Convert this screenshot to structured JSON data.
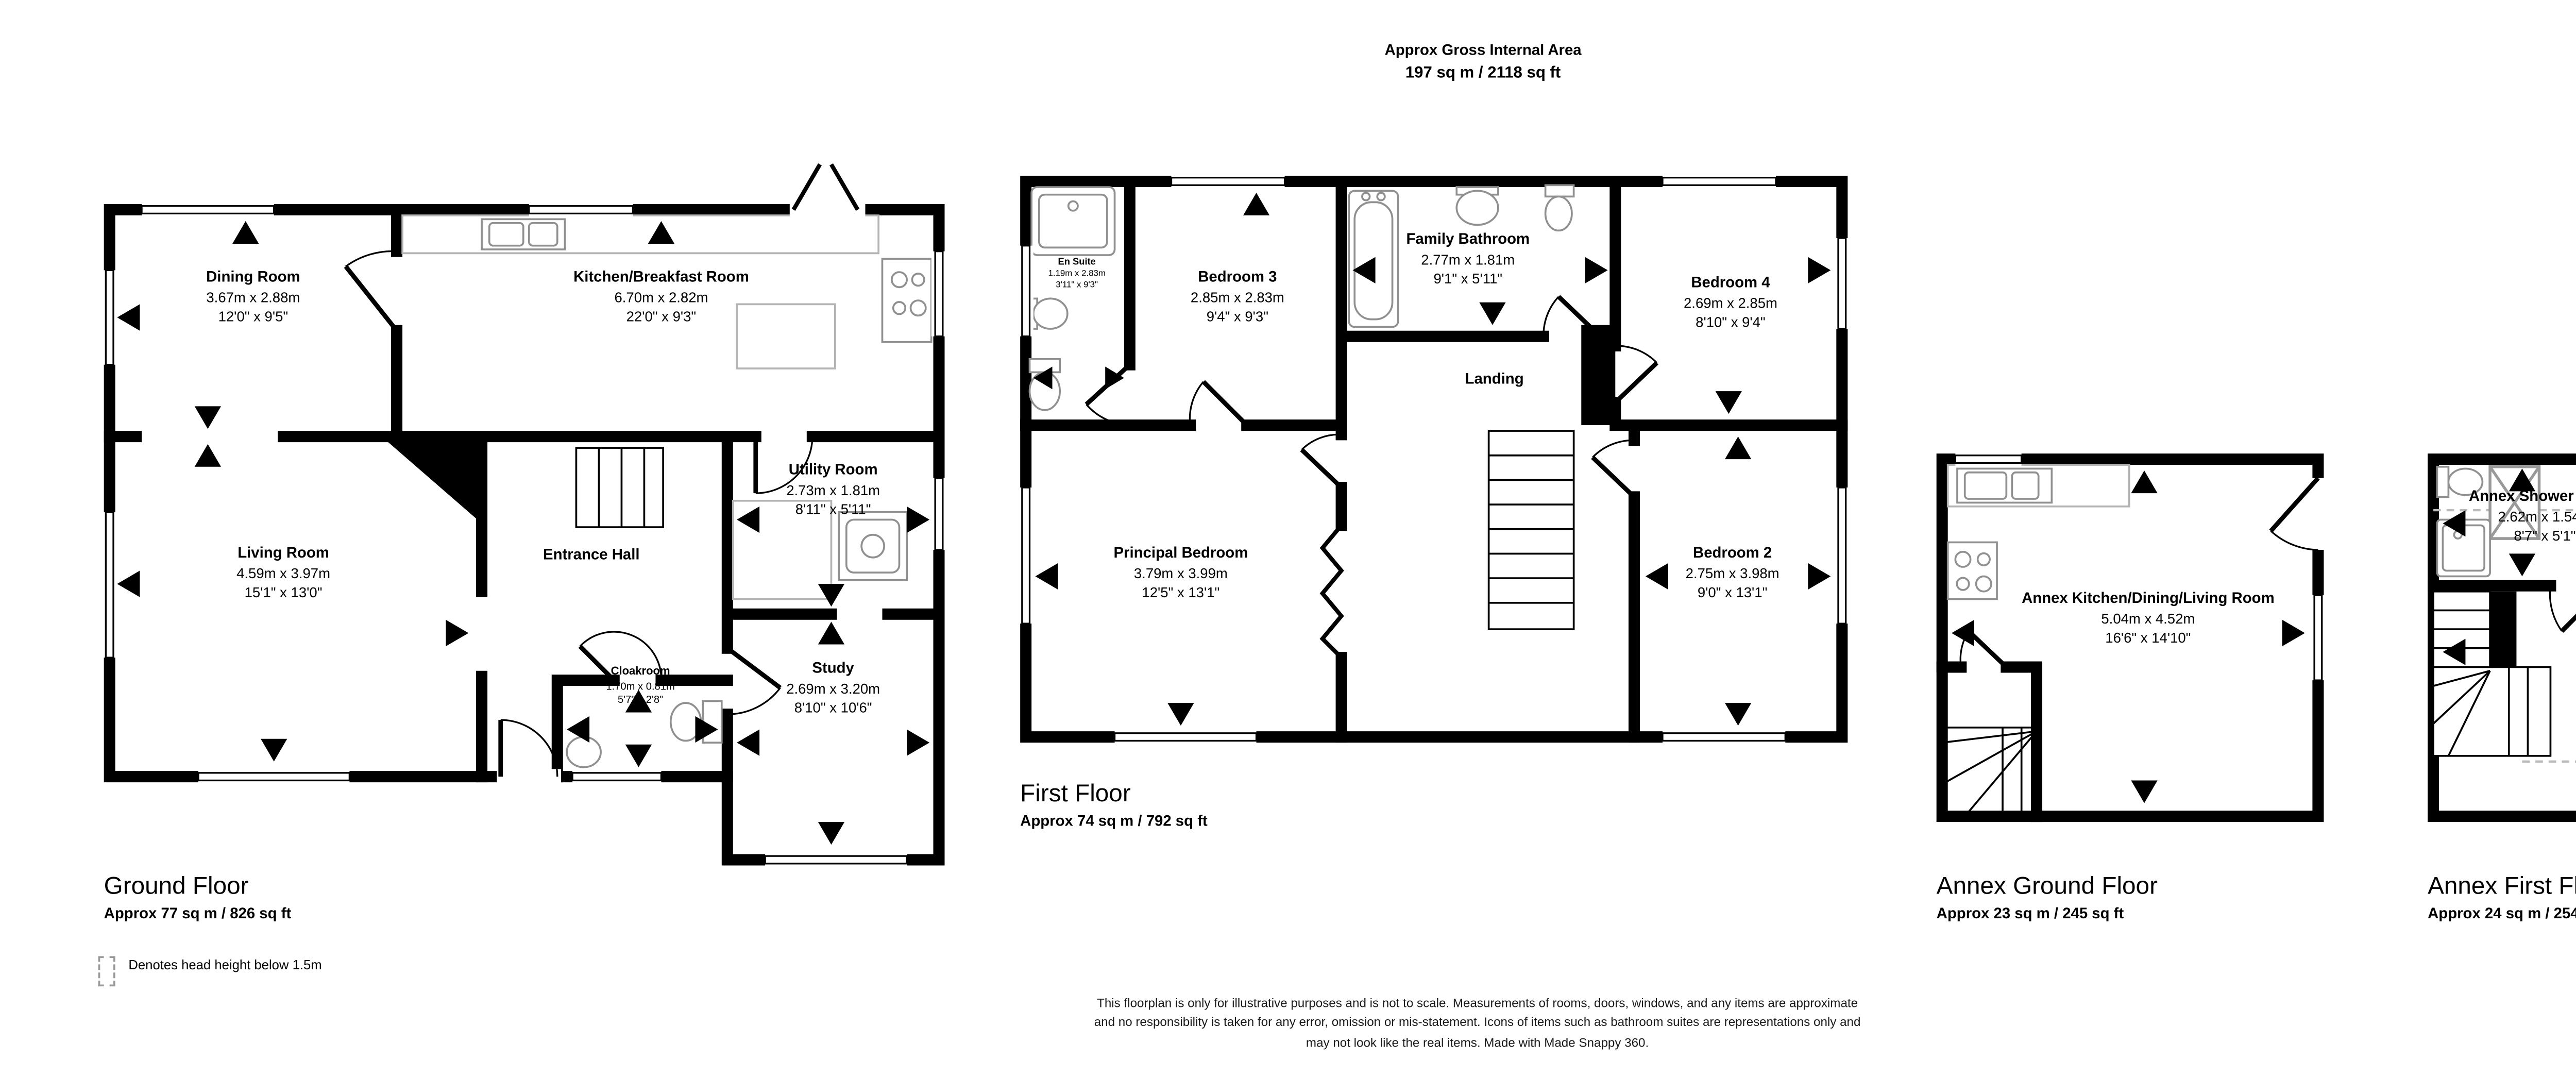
{
  "header": {
    "title": "Approx Gross Internal Area",
    "area": "197 sq m / 2118 sq ft"
  },
  "floors": [
    {
      "caption": "Ground Floor",
      "area": "Approx 77 sq m / 826 sq ft",
      "rooms": {
        "dining": {
          "name": "Dining Room",
          "metric": "3.67m x 2.88m",
          "imperial": "12'0\" x 9'5\""
        },
        "kitchen": {
          "name": "Kitchen/Breakfast Room",
          "metric": "6.70m x 2.82m",
          "imperial": "22'0\" x 9'3\""
        },
        "living": {
          "name": "Living Room",
          "metric": "4.59m x 3.97m",
          "imperial": "15'1\" x 13'0\""
        },
        "hall": {
          "name": "Entrance Hall"
        },
        "utility": {
          "name": "Utility Room",
          "metric": "2.73m x 1.81m",
          "imperial": "8'11\" x 5'11\""
        },
        "cloak": {
          "name": "Cloakroom",
          "metric": "1.70m x 0.81m",
          "imperial": "5'7\" x 2'8\""
        },
        "study": {
          "name": "Study",
          "metric": "2.69m x 3.20m",
          "imperial": "8'10\" x 10'6\""
        }
      }
    },
    {
      "caption": "First Floor",
      "area": "Approx 74 sq m / 792 sq ft",
      "rooms": {
        "ensuite": {
          "name": "En Suite",
          "metric": "1.19m x 2.83m",
          "imperial": "3'11\" x 9'3\""
        },
        "bed3": {
          "name": "Bedroom 3",
          "metric": "2.85m x 2.83m",
          "imperial": "9'4\" x 9'3\""
        },
        "bath": {
          "name": "Family Bathroom",
          "metric": "2.77m x 1.81m",
          "imperial": "9'1\" x 5'11\""
        },
        "bed4": {
          "name": "Bedroom 4",
          "metric": "2.69m x 2.85m",
          "imperial": "8'10\" x 9'4\""
        },
        "landing": {
          "name": "Landing"
        },
        "principal": {
          "name": "Principal Bedroom",
          "metric": "3.79m x 3.99m",
          "imperial": "12'5\" x 13'1\""
        },
        "bed2": {
          "name": "Bedroom 2",
          "metric": "2.75m x 3.98m",
          "imperial": "9'0\" x 13'1\""
        }
      }
    },
    {
      "caption": "Annex Ground Floor",
      "area": "Approx 23 sq m / 245 sq ft",
      "rooms": {
        "akdl": {
          "name": "Annex Kitchen/Dining/Living Room",
          "metric": "5.04m x 4.52m",
          "imperial": "16'6\" x 14'10\""
        }
      }
    },
    {
      "caption": "Annex First Floor",
      "area": "Approx 24 sq m / 254 sq ft",
      "rooms": {
        "ashower": {
          "name": "Annex Shower Room",
          "metric": "2.62m x 1.54m",
          "imperial": "8'7\" x 5'1\""
        },
        "abed": {
          "name": "Annex Bedroom",
          "metric": "5.19m x 4.57m",
          "imperial": "17'0\" x 15'0\""
        }
      }
    }
  ],
  "legend": {
    "icon": "head-height-dashed-box",
    "label": "Denotes head height below 1.5m"
  },
  "disclaimer": {
    "line1": "This floorplan is only for illustrative purposes and is not to scale. Measurements of rooms, doors, windows, and any items are approximate",
    "line2": "and no responsibility is taken for any error, omission or mis-statement. Icons of items such as bathroom suites are representations only and",
    "line3": "may not look like the real items. Made with Made Snappy 360."
  },
  "colors": {
    "wall": "#000000",
    "fixture": "#909090",
    "counter": "#b3b3b3",
    "head_height_dash": "#bbbbbb"
  }
}
